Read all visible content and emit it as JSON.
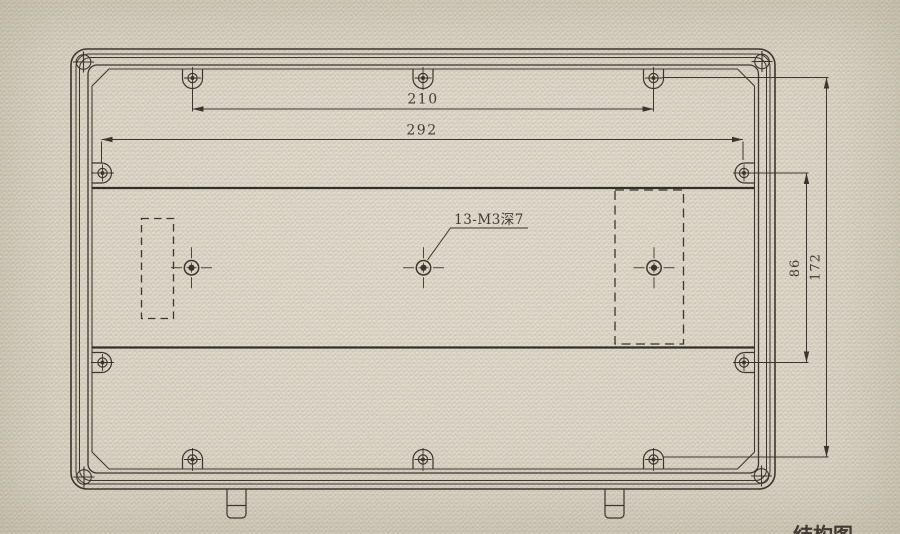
{
  "page": {
    "background_color": "#d7d2c3",
    "line_color": "#3b352e"
  },
  "dimensions": {
    "top_hole_spacing": "210",
    "side_hole_spacing": "292",
    "right_inner_spacing": "86",
    "right_outer_spacing": "172"
  },
  "callouts": {
    "thread_note": "13-M3深7",
    "bottom_partial_label": "结构图"
  }
}
